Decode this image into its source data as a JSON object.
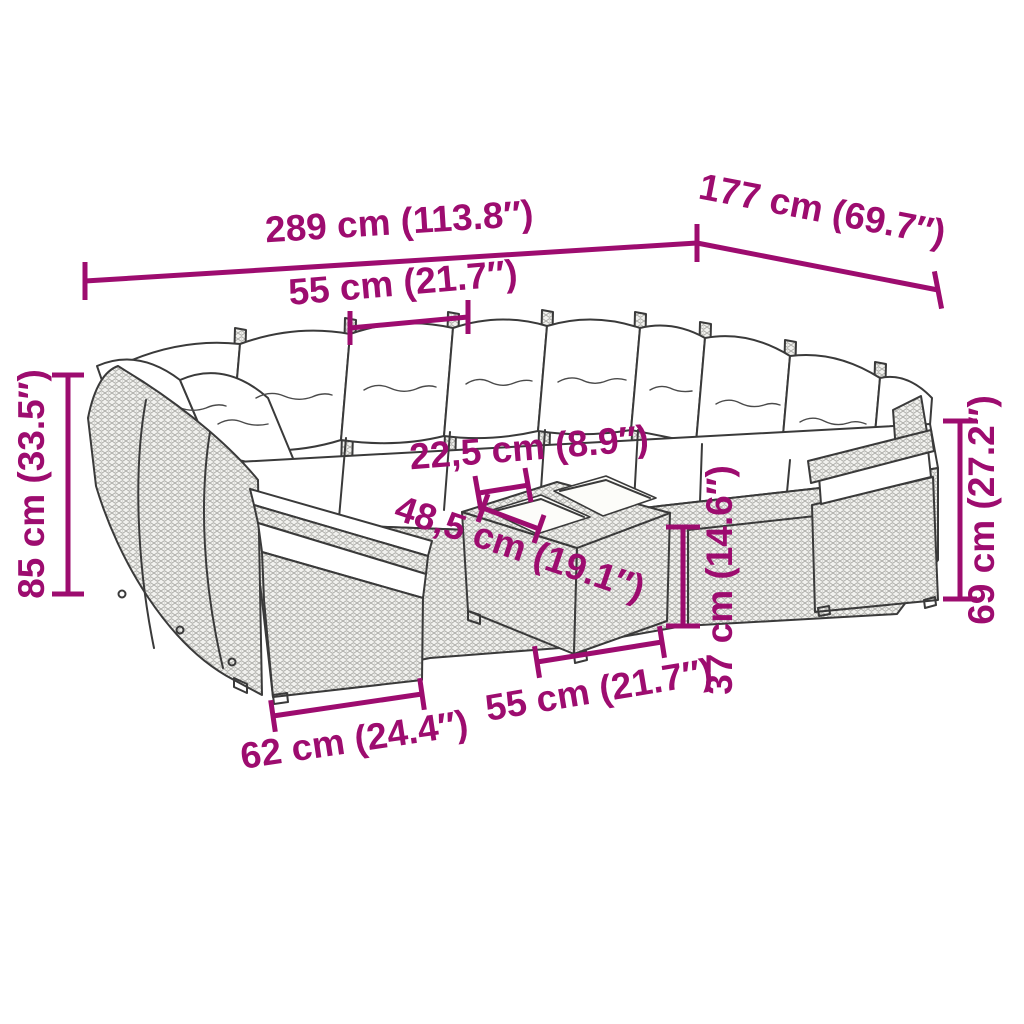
{
  "diagram": {
    "description": "Technical dimension drawing of a poly rattan garden lounge set with cushions and a glass-top coffee table",
    "background_color": "#ffffff",
    "outline_color": "#3a3a3a",
    "dimension_color": "#9d0c6f",
    "cushion_color": "#ffffff",
    "units": "cm / inches"
  },
  "dimensions": {
    "overall_width": "289 cm (113.8″)",
    "overall_depth": "177 cm (69.7″)",
    "seat_width": "55 cm (21.7″)",
    "overall_height": "85 cm (33.5″)",
    "glass_panel_width": "22,5 cm (8.9″)",
    "table_depth": "48,5 cm (19.1″)",
    "backrest_height": "69 cm (27.2″)",
    "table_height": "37 cm (14.6″)",
    "table_width": "55 cm (21.7″)",
    "end_module_width": "62 cm (24.4″)"
  }
}
